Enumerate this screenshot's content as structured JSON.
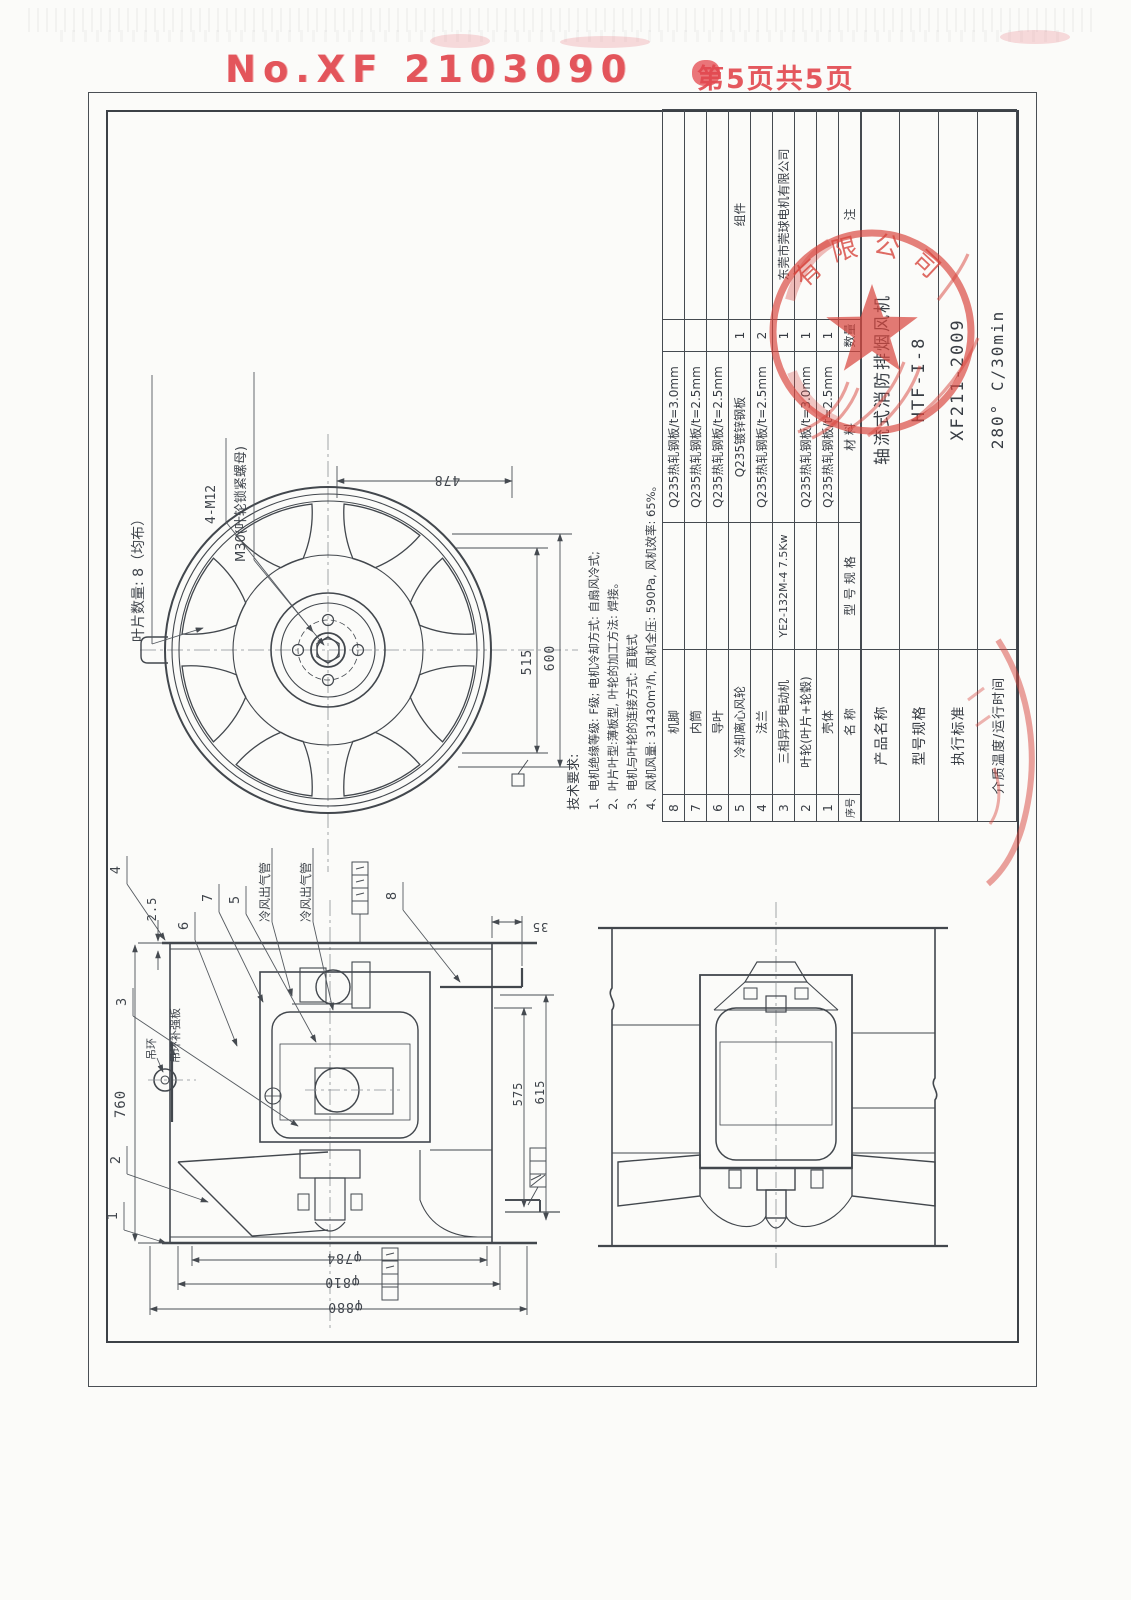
{
  "page": {
    "doc_no": "No.XF 2103090",
    "page_info": "第5页共5页"
  },
  "front_view": {
    "blade_count_label": "叶片数量: 8（均布）",
    "bolt_label": "4-M12",
    "nut_label": "M30(叶轮锁紧螺母)",
    "dims": {
      "width": "478",
      "inner_dia": "515",
      "outer_dia": "600"
    }
  },
  "tech_req": {
    "title": "技术要求:",
    "items": [
      "1、电机绝缘等级: F级;  电机冷却方式: 自扇风冷式;",
      "2、叶片叶型:薄板型, 叶轮的加工方法: 焊接。",
      "3、电机与叶轮的连接方式: 直联式",
      "4、风机风量: 31430m³/h, 风机全压: 590Pa, 风机效率: 65%。"
    ]
  },
  "parts_table": {
    "headers": {
      "no": "序号",
      "name": "名  称",
      "spec": "型 号 规 格",
      "material": "材  料",
      "qty": "数量",
      "note": "注"
    },
    "rows": [
      {
        "no": "8",
        "name": "机脚",
        "spec": "",
        "material": "Q235热轧钢板/t=3.0mm",
        "qty": "",
        "note": ""
      },
      {
        "no": "7",
        "name": "内筒",
        "spec": "",
        "material": "Q235热轧钢板/t=2.5mm",
        "qty": "",
        "note": ""
      },
      {
        "no": "6",
        "name": "导叶",
        "spec": "",
        "material": "Q235热轧钢板/t=2.5mm",
        "qty": "",
        "note": ""
      },
      {
        "no": "5",
        "name": "冷却离心风轮",
        "spec": "",
        "material": "Q235镀锌钢板",
        "qty": "1",
        "note": "组件"
      },
      {
        "no": "4",
        "name": "法兰",
        "spec": "",
        "material": "Q235热轧钢板/t=2.5mm",
        "qty": "2",
        "note": ""
      },
      {
        "no": "3",
        "name": "三相异步电动机",
        "spec": "YE2-132M-4 7.5Kw",
        "material": "",
        "qty": "1",
        "note": "东莞市莞球电机有限公司"
      },
      {
        "no": "2",
        "name": "叶轮(叶片+轮毂)",
        "spec": "",
        "material": "Q235热轧钢板/t=3.0mm",
        "qty": "1",
        "note": ""
      },
      {
        "no": "1",
        "name": "壳体",
        "spec": "",
        "material": "Q235热轧钢板/t=2.5mm",
        "qty": "1",
        "note": ""
      }
    ]
  },
  "title_block": {
    "rows": [
      {
        "label": "产品名称",
        "value": "轴流式消防排烟风机"
      },
      {
        "label": "型号规格",
        "value": "HTF-I-8"
      },
      {
        "label": "执行标准",
        "value": "XF211-2009"
      },
      {
        "label": "介质温度/运行时间",
        "value": "280° C/30min"
      }
    ]
  },
  "left_view": {
    "callouts": {
      "n1": "1",
      "n2": "2",
      "n3": "3",
      "n4": "4",
      "n5": "5",
      "n6": "6",
      "n7": "7",
      "n8": "8"
    },
    "labels": {
      "outlet_pipe_a": "冷风出气管",
      "outlet_pipe_b": "冷风出气管",
      "lifting_ring": "吊环",
      "lifting_ring_plate": "吊环补强板"
    },
    "dims": {
      "length": "760",
      "flange_t": "2.5",
      "gap": "35",
      "inner_len": "575",
      "outer_len": "615"
    }
  },
  "bottom_dims": {
    "d1": "φ784",
    "d2": "φ810",
    "d3": "φ880"
  },
  "stamps": {
    "seal_arc": "有限公司"
  }
}
